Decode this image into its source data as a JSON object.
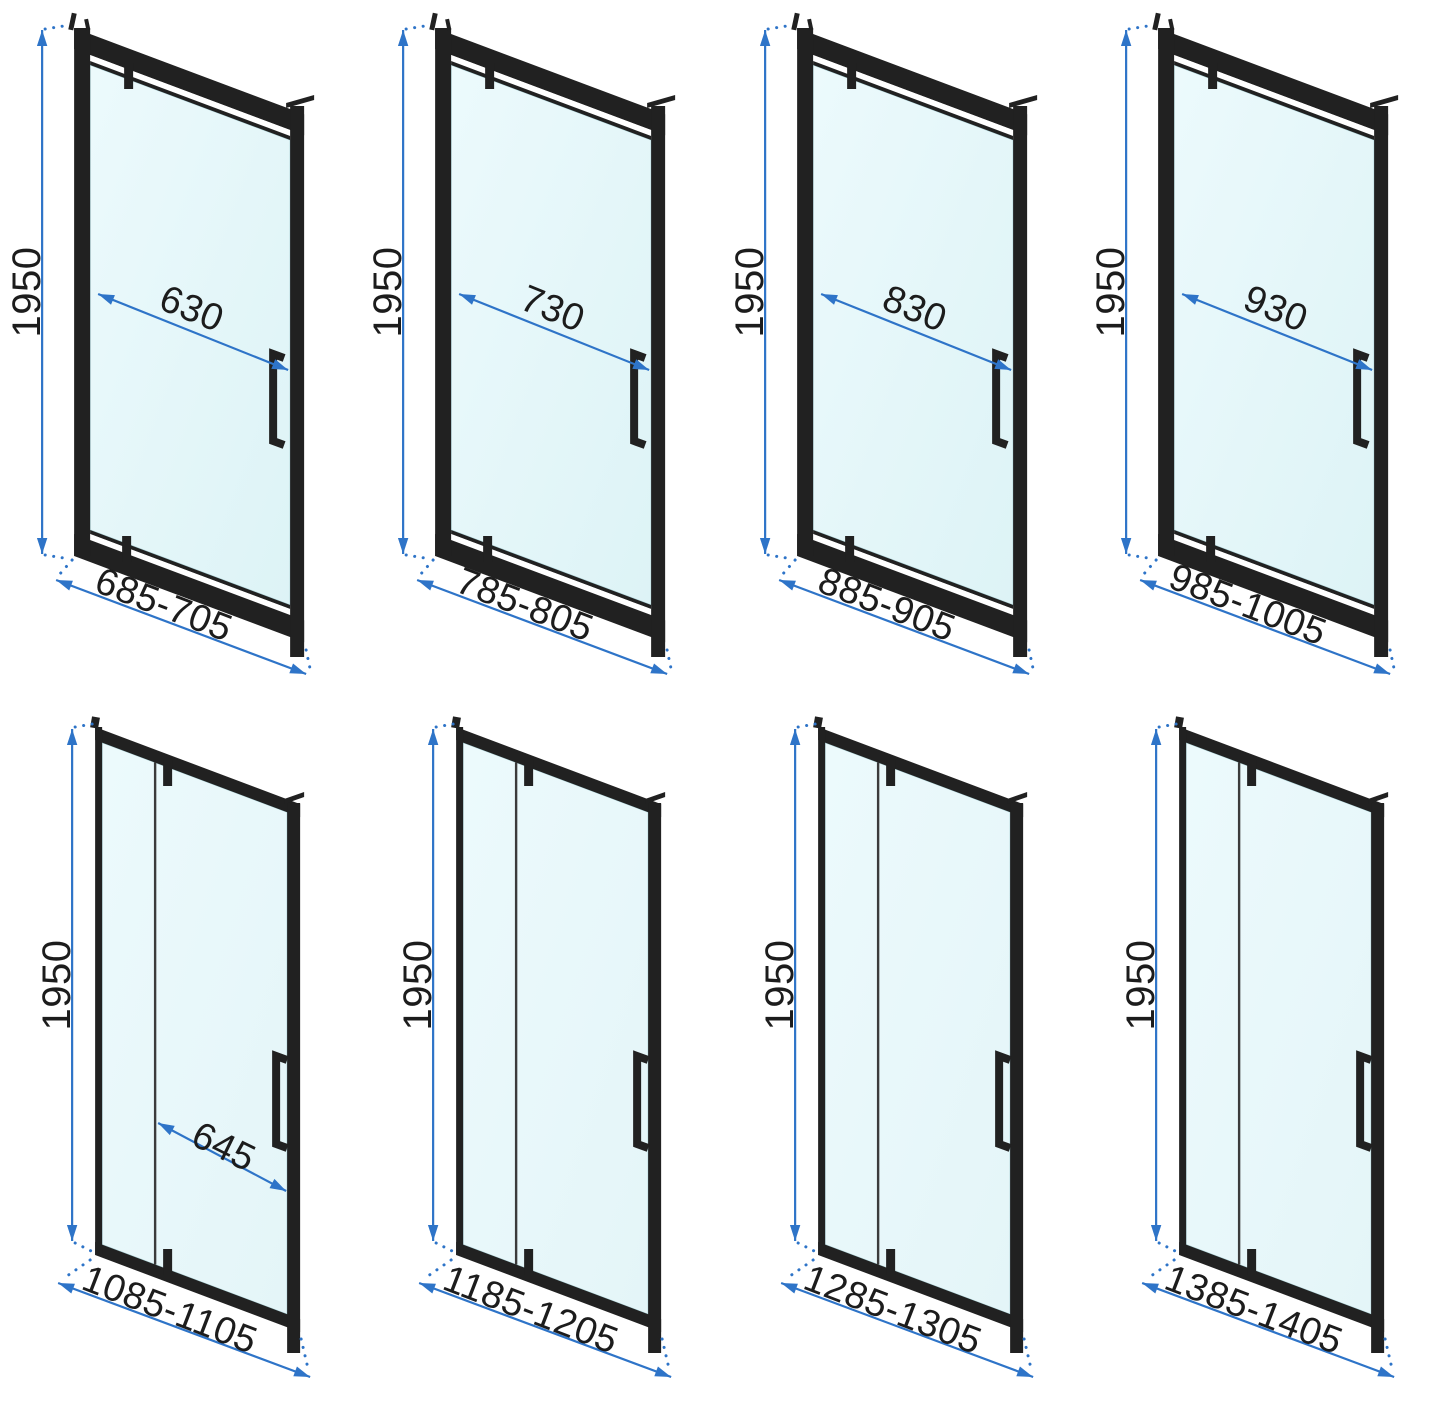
{
  "colors": {
    "background": "#ffffff",
    "frame": "#212121",
    "frame_gap": "#ffffff",
    "glass_top_row": "#ddf3f6",
    "glass_bottom_row": "#e4f5f8",
    "glass_edge": "#aed3d8",
    "panel_divider": "#3b3b3b",
    "dimension_line": "#2e74c8",
    "dimension_text": "#1c1c1c"
  },
  "diagrams": [
    {
      "row": "top",
      "panels": 1,
      "height_mm": "1950",
      "door_width_mm": "630",
      "width_range_mm": "685-705"
    },
    {
      "row": "top",
      "panels": 1,
      "height_mm": "1950",
      "door_width_mm": "730",
      "width_range_mm": "785-805"
    },
    {
      "row": "top",
      "panels": 1,
      "height_mm": "1950",
      "door_width_mm": "830",
      "width_range_mm": "885-905"
    },
    {
      "row": "top",
      "panels": 1,
      "height_mm": "1950",
      "door_width_mm": "930",
      "width_range_mm": "985-1005"
    },
    {
      "row": "bottom",
      "panels": 2,
      "height_mm": "1950",
      "door_width_mm": "645",
      "width_range_mm": "1085-1105"
    },
    {
      "row": "bottom",
      "panels": 2,
      "height_mm": "1950",
      "door_width_mm": null,
      "width_range_mm": "1185-1205"
    },
    {
      "row": "bottom",
      "panels": 2,
      "height_mm": "1950",
      "door_width_mm": null,
      "width_range_mm": "1285-1305"
    },
    {
      "row": "bottom",
      "panels": 2,
      "height_mm": "1950",
      "door_width_mm": null,
      "width_range_mm": "1385-1405"
    }
  ]
}
